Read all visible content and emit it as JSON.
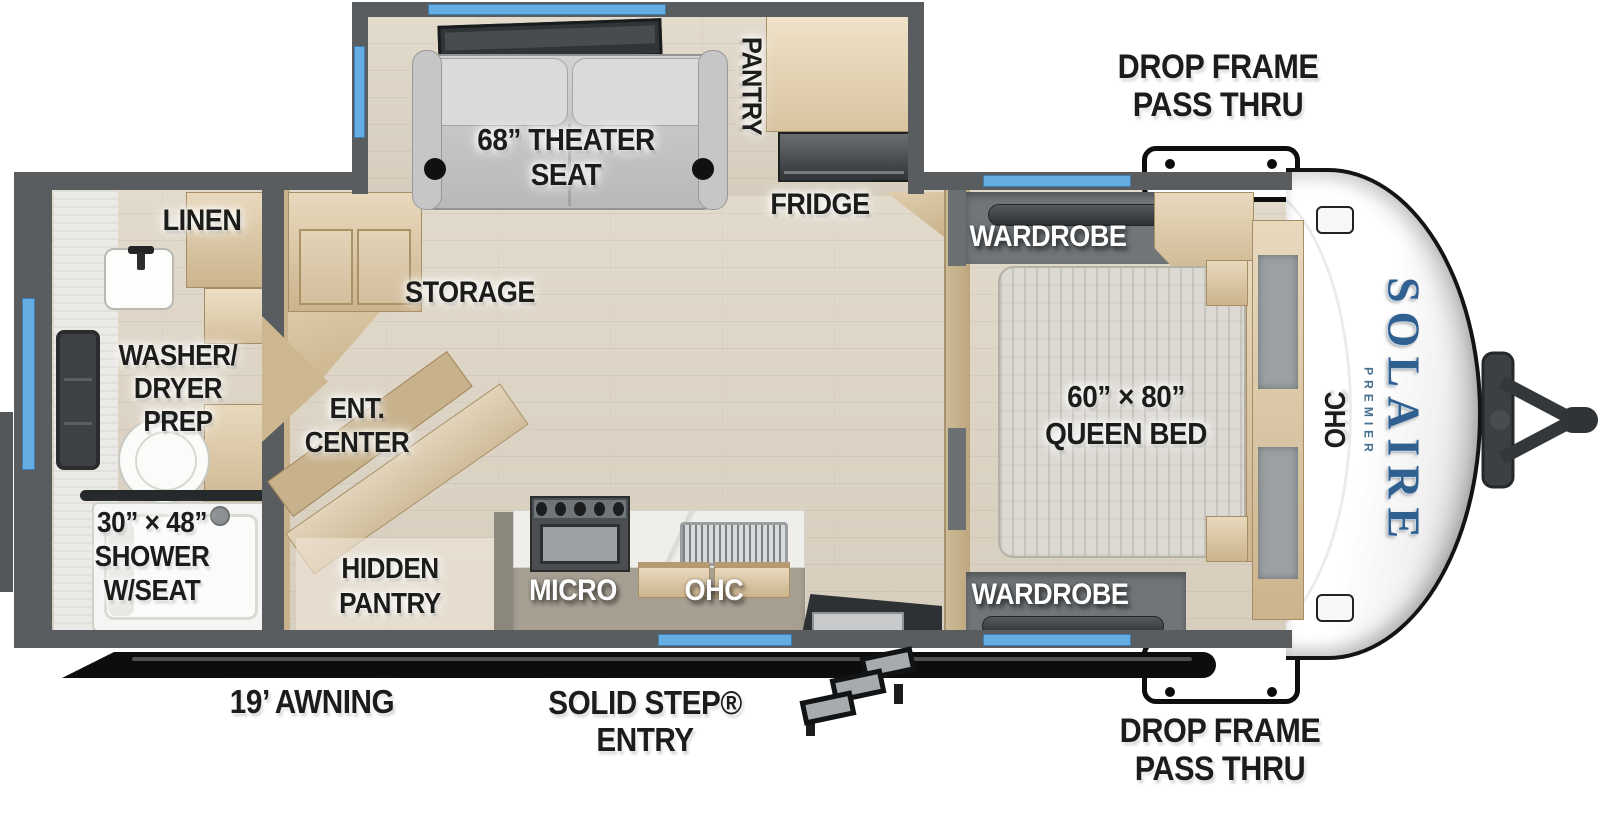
{
  "brand": {
    "name": "SOLAIRE",
    "sub": "PREMIER"
  },
  "colors": {
    "wall": "#595d5f",
    "window": "#64aee4",
    "floor": "#ded5c6",
    "wood": "#d8c5a3",
    "brand_blue": "#30608f",
    "awning": "#0c0d0e",
    "label_dark": "#1c1c1a",
    "label_light": "#ffffff"
  },
  "labels": {
    "drop_frame_top": {
      "line1": "DROP FRAME",
      "line2": "PASS THRU"
    },
    "drop_frame_bottom": {
      "line1": "DROP FRAME",
      "line2": "PASS THRU"
    },
    "theater_seat": {
      "line1": "68” THEATER",
      "line2": "SEAT"
    },
    "pantry": "PANTRY",
    "fridge": "FRIDGE",
    "linen": "LINEN",
    "washer_dryer": {
      "line1": "WASHER/",
      "line2": "DRYER",
      "line3": "PREP"
    },
    "shower": {
      "line1": "30” × 48”",
      "line2": "SHOWER",
      "line3": "W/SEAT"
    },
    "storage": "STORAGE",
    "ent_center": {
      "line1": "ENT.",
      "line2": "CENTER"
    },
    "hidden_pantry": {
      "line1": "HIDDEN",
      "line2": "PANTRY"
    },
    "micro": "MICRO",
    "ohc_kitchen": "OHC",
    "wardrobe_top": "WARDROBE",
    "wardrobe_bottom": "WARDROBE",
    "queen_bed": {
      "line1": "60” × 80”",
      "line2": "QUEEN BED"
    },
    "ohc_front": "OHC",
    "awning": "19’ AWNING",
    "entry": {
      "line1": "SOLID STEP®",
      "line2": "ENTRY"
    }
  }
}
